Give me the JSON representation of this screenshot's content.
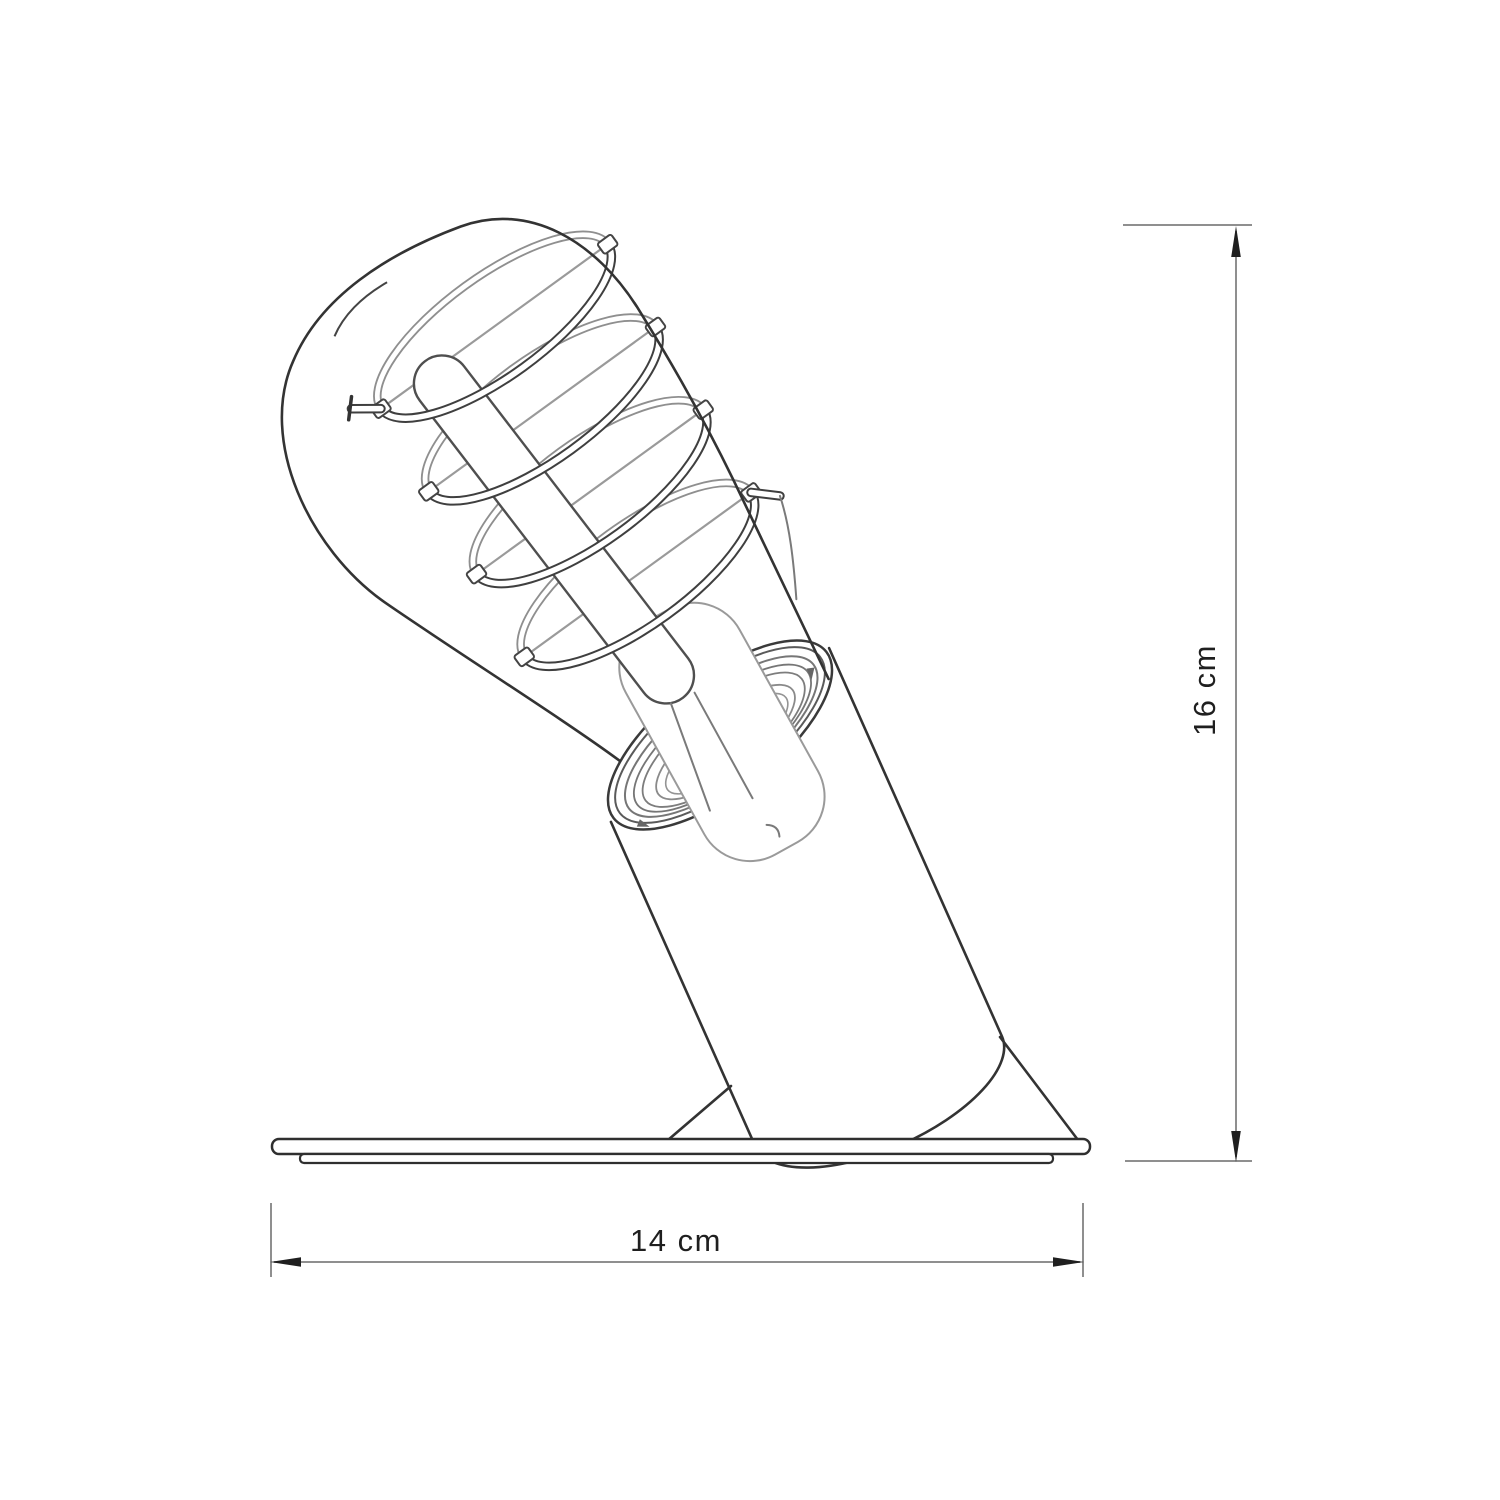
{
  "page": {
    "background": "#ffffff",
    "kind": "technical-dimension-drawing"
  },
  "drawing": {
    "subject": "tilted-cylinder-table-lamp-with-edison-spiral-filament-bulb-on-flat-base",
    "outline_color": "#333333",
    "detail_color": "#8a8a8a"
  },
  "dimensions": {
    "line_color": "#8f8f8f",
    "arrow_color": "#1f1f1f",
    "height": {
      "label": "16 cm",
      "value": 16,
      "unit": "cm",
      "orientation": "vertical"
    },
    "width": {
      "label": "14 cm",
      "value": 14,
      "unit": "cm",
      "orientation": "horizontal"
    }
  }
}
